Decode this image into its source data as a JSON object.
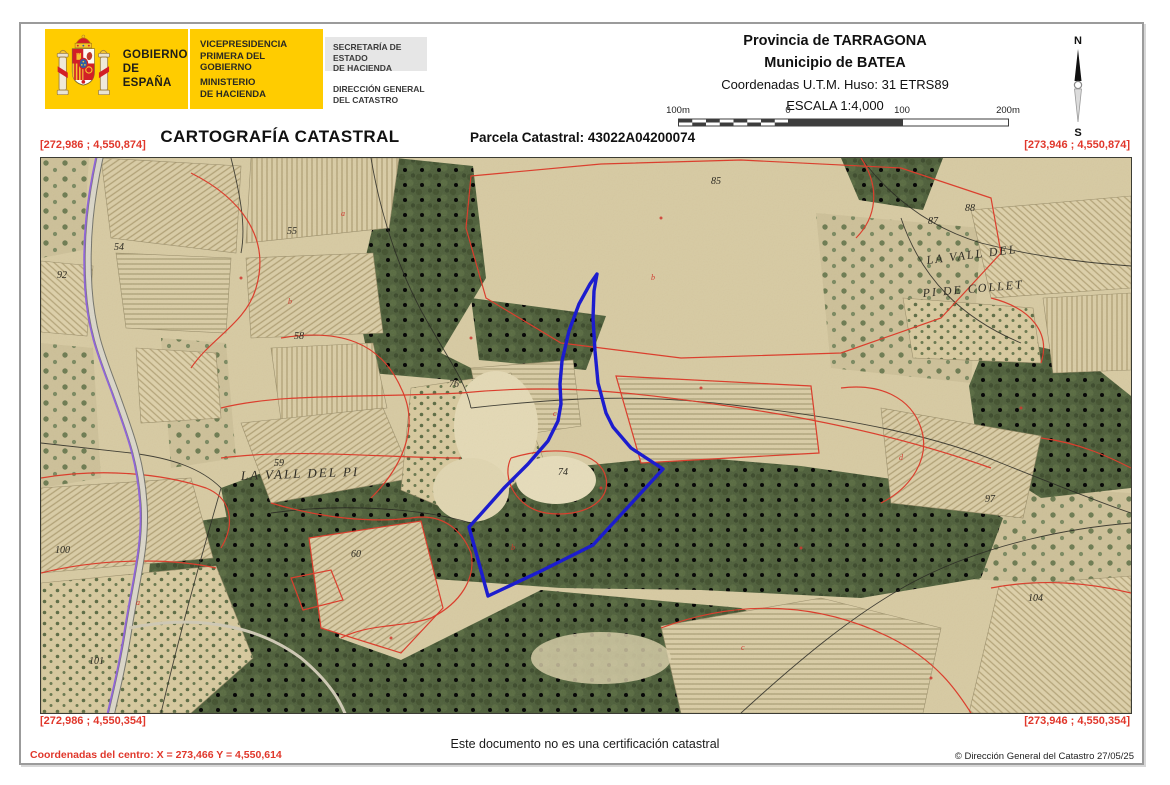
{
  "colors": {
    "logo_yellow": "#FFCC00",
    "coordinate_red": "#E0372B",
    "highlight_blue": "#1616CF",
    "cadastral_line_red": "#DC3A28",
    "road_purple": "#8E62D9"
  },
  "logo": {
    "gobierno": [
      "GOBIERNO",
      "DE ESPAÑA"
    ],
    "vicepresidencia": [
      "VICEPRESIDENCIA",
      "PRIMERA DEL GOBIERNO"
    ],
    "ministerio": [
      "MINISTERIO",
      "DE HACIENDA"
    ],
    "secretaria": [
      "SECRETARÍA DE ESTADO",
      "DE HACIENDA"
    ],
    "direccion": [
      "DIRECCIÓN GENERAL",
      "DEL CATASTRO"
    ]
  },
  "header": {
    "provincia": "Provincia de TARRAGONA",
    "municipio": "Municipio de BATEA",
    "coordenadas": "Coordenadas U.T.M. Huso: 31 ETRS89",
    "escala": "ESCALA 1:4,000",
    "scalebar_labels": [
      "100m",
      "0",
      "100",
      "200m"
    ],
    "compass": {
      "north": "N",
      "south": "S"
    }
  },
  "title": "CARTOGRAFÍA CATASTRAL",
  "parcel_label": "Parcela Catastral: 43022A04200074",
  "map": {
    "corner_coordinates": {
      "top_left": "[272,986 ; 4,550,874]",
      "top_right": "[273,946 ; 4,550,874]",
      "bottom_left": "[272,986 ; 4,550,354]",
      "bottom_right": "[273,946 ; 4,550,354]"
    },
    "place_labels": [
      {
        "text": "LA VALL DEL PI",
        "x": 200,
        "y": 322,
        "rot": -2,
        "size": 13
      },
      {
        "text": "LA VALL DEL",
        "x": 886,
        "y": 106,
        "rot": -7,
        "size": 12
      },
      {
        "text": "PI DE COLLET",
        "x": 882,
        "y": 139,
        "rot": -5,
        "size": 12
      }
    ],
    "parcel_numbers": [
      {
        "n": "54",
        "x": 73,
        "y": 92
      },
      {
        "n": "92",
        "x": 16,
        "y": 120
      },
      {
        "n": "55",
        "x": 246,
        "y": 76
      },
      {
        "n": "58",
        "x": 253,
        "y": 181
      },
      {
        "n": "76",
        "x": 408,
        "y": 229
      },
      {
        "n": "59",
        "x": 233,
        "y": 308
      },
      {
        "n": "74",
        "x": 517,
        "y": 317
      },
      {
        "n": "85",
        "x": 670,
        "y": 26
      },
      {
        "n": "88",
        "x": 924,
        "y": 53
      },
      {
        "n": "87",
        "x": 887,
        "y": 66
      },
      {
        "n": "100",
        "x": 14,
        "y": 395
      },
      {
        "n": "101",
        "x": 48,
        "y": 506
      },
      {
        "n": "60",
        "x": 310,
        "y": 399
      },
      {
        "n": "97",
        "x": 944,
        "y": 344
      },
      {
        "n": "104",
        "x": 987,
        "y": 443
      }
    ],
    "subparcel_letters": [
      {
        "t": "a",
        "x": 300,
        "y": 58
      },
      {
        "t": "b",
        "x": 247,
        "y": 146
      },
      {
        "t": "b",
        "x": 610,
        "y": 122
      },
      {
        "t": "c",
        "x": 512,
        "y": 258
      },
      {
        "t": "a",
        "x": 95,
        "y": 447
      },
      {
        "t": "c",
        "x": 700,
        "y": 492
      },
      {
        "t": "d",
        "x": 858,
        "y": 302
      },
      {
        "t": "b",
        "x": 470,
        "y": 392
      }
    ]
  },
  "footer": {
    "disclaimer": "Este documento no es una certificación catastral",
    "center_coordinates": "Coordenadas del centro: X = 273,466 Y = 4,550,614",
    "copyright": "© Dirección General del Catastro 27/05/25"
  }
}
